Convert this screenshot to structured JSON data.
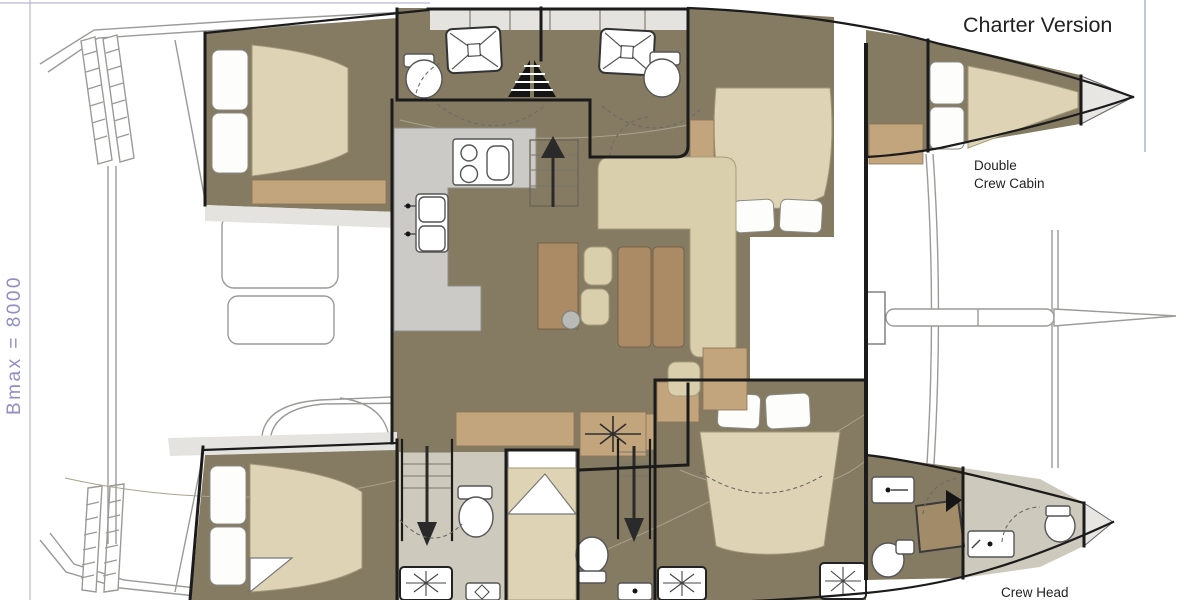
{
  "title": "Charter Version",
  "dimension_label": "Bmax = 8000",
  "labels": {
    "double_crew_cabin_line1": "Double",
    "double_crew_cabin_line2": "Crew Cabin",
    "crew_head": "Crew Head"
  },
  "colors": {
    "background": "#ffffff",
    "floor": "#857b63",
    "wood": "#ab8a66",
    "wood_light": "#c2a47d",
    "mattress": "#ded4b5",
    "upholstery": "#d9cfad",
    "counter": "#cbcac6",
    "walkway": "#e4e3df",
    "wall": "#1b1b1b",
    "outline": "#9a9a98",
    "dimension_text": "#8f8fc8",
    "label_text": "#222222"
  }
}
